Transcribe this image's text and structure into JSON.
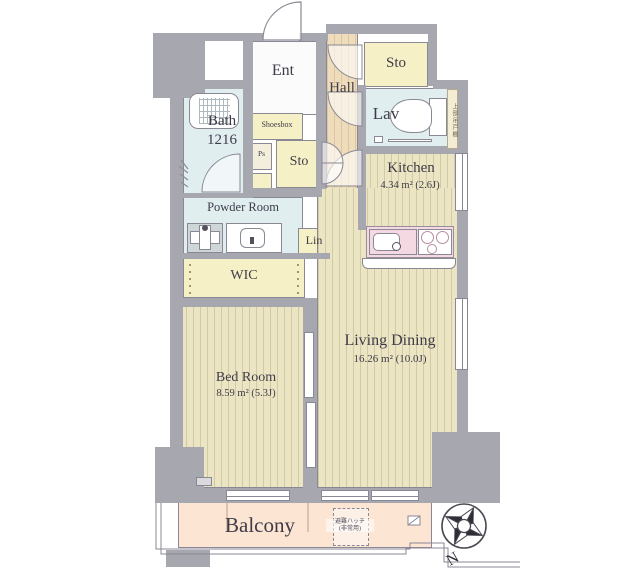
{
  "rooms": {
    "ent": {
      "label": "Ent"
    },
    "hall": {
      "label": "Hall"
    },
    "sto_top": {
      "label": "Sto"
    },
    "lav": {
      "label": "Lav"
    },
    "kitchen": {
      "label": "Kitchen",
      "area": "4.34 m² (2.6J)"
    },
    "bath": {
      "label": "Bath",
      "size": "1216"
    },
    "shoesbox": {
      "label": "Shoesbox"
    },
    "ps": {
      "label": "Ps"
    },
    "sto_mid": {
      "label": "Sto"
    },
    "powder_room": {
      "label": "Powder Room"
    },
    "lin": {
      "label": "Lin"
    },
    "wic": {
      "label": "WIC"
    },
    "bedroom": {
      "label": "Bed Room",
      "area": "8.59 m² (5.3J)"
    },
    "living_dining": {
      "label": "Living Dining",
      "area": "16.26 m² (10.0J)"
    },
    "balcony": {
      "label": "Balcony"
    }
  },
  "annotations": {
    "evacuation_hatch_line1": "避難ハッチ",
    "evacuation_hatch_line2": "(非常用)",
    "upper_cabinet": "上部吊戸棚",
    "compass_north": "N"
  },
  "colors": {
    "wall": "#a7a7b0",
    "floor": "#ece5c3",
    "hall_floor": "#eedcba",
    "closet": "#f6f0c6",
    "wet_room": "#e0eef0",
    "balcony": "#fce5d3",
    "counter": "#f5d9e2",
    "outline": "#8a8894",
    "text": "#3f3c49"
  }
}
